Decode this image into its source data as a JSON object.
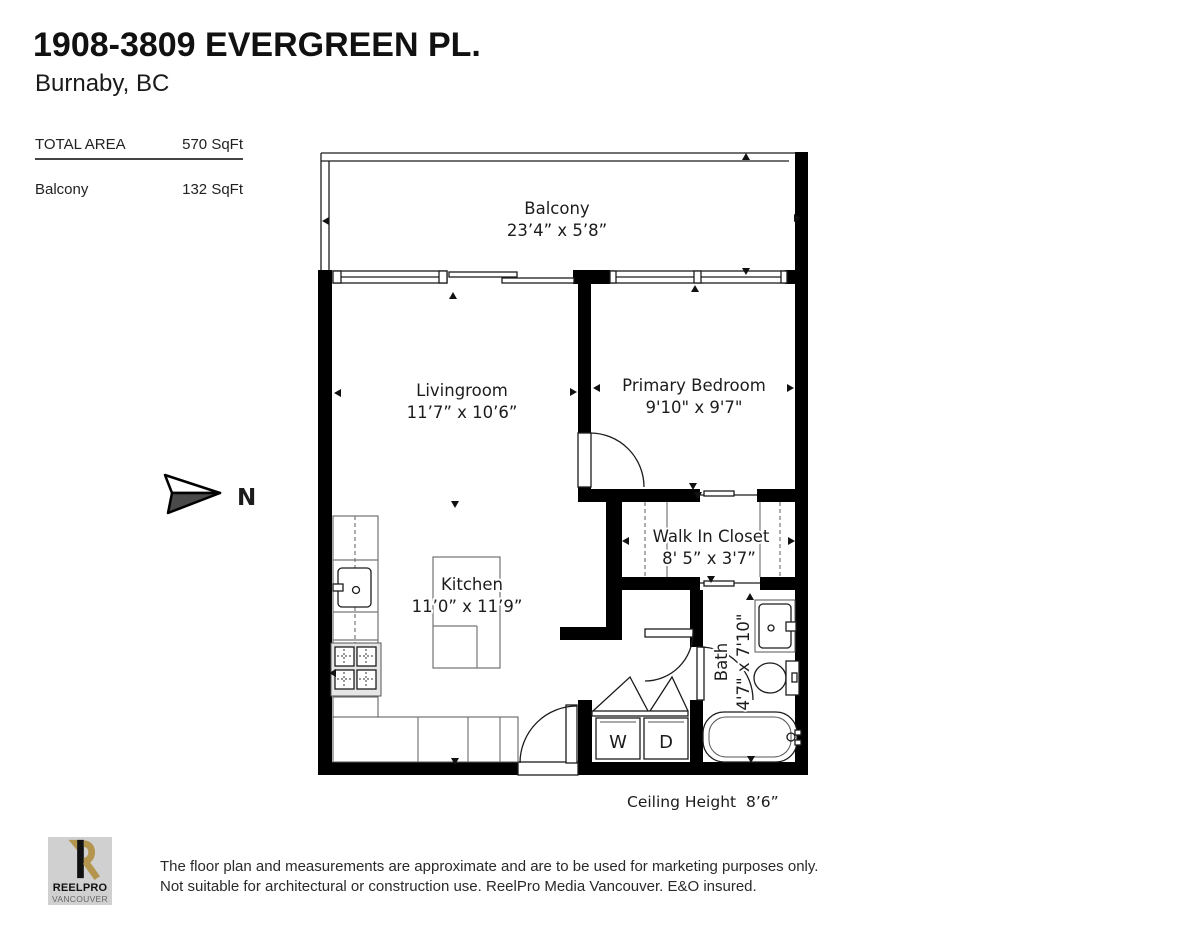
{
  "header": {
    "title": "1908-3809 EVERGREEN PL.",
    "subtitle": "Burnaby, BC"
  },
  "areas": {
    "total_label": "TOTAL AREA",
    "total_value": "570 SqFt",
    "balcony_label": "Balcony",
    "balcony_value": "132 SqFt"
  },
  "compass": {
    "label": "N"
  },
  "rooms": {
    "balcony": {
      "name": "Balcony",
      "dims": "23’4” x 5’8”"
    },
    "livingroom": {
      "name": "Livingroom",
      "dims": "11’7” x 10’6”"
    },
    "primary_bedroom": {
      "name": "Primary Bedroom",
      "dims": "9'10\" x 9'7\""
    },
    "walk_in_closet": {
      "name": "Walk In Closet",
      "dims": "8' 5” x 3'7”"
    },
    "kitchen": {
      "name": "Kitchen",
      "dims": "11’0” x 11’9”"
    },
    "bath": {
      "name": "Bath",
      "dims": "4'7\" x 7'10\""
    }
  },
  "laundry": {
    "washer": "W",
    "dryer": "D"
  },
  "ceiling": {
    "label": "Ceiling Height",
    "value": "8’6”"
  },
  "footer": {
    "logo_line1": "REELPRO",
    "logo_line2": "VANCOUVER",
    "disclaimer_line1": "The floor plan and measurements are approximate and are to be used for marketing purposes only.",
    "disclaimer_line2": "Not suitable for architectural or construction use. ReelPro Media Vancouver. E&O insured."
  },
  "colors": {
    "wall": "#000000",
    "logo_gold": "#b3954e",
    "logo_bg": "#d0d0d0"
  }
}
